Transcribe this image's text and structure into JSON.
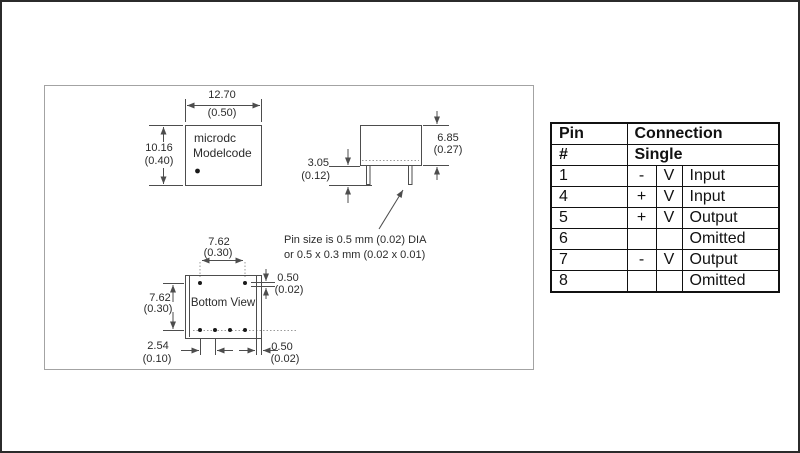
{
  "drawing": {
    "top_view": {
      "width_mm": "12.70",
      "width_in": "(0.50)",
      "height_mm": "10.16",
      "height_in": "(0.40)",
      "label_line1": "microdc",
      "label_line2": "Modelcode"
    },
    "side_view": {
      "body_height_mm": "6.85",
      "body_height_in": "(0.27)",
      "pin_length_mm": "3.05",
      "pin_length_in": "(0.12)"
    },
    "pin_note_line1": "Pin size is 0.5 mm (0.02) DIA",
    "pin_note_line2": "or 0.5 x 0.3 mm (0.02 x 0.01)",
    "bottom_view": {
      "label": "Bottom View",
      "pin_span_mm": "7.62",
      "pin_span_in": "(0.30)",
      "row_span_mm": "7.62",
      "row_span_in": "(0.30)",
      "pitch_mm": "2.54",
      "pitch_in": "(0.10)",
      "edge_offset_mm": "0.50",
      "edge_offset_in": "(0.02)",
      "side_offset_mm": "0.50",
      "side_offset_in": "(0.02)"
    }
  },
  "pin_table": {
    "header_col1": "Pin",
    "header_col2": "Connection",
    "subheader_col1": "#",
    "subheader_col2": "Single",
    "rows": [
      {
        "pin": "1",
        "sign": "-",
        "unit": "V",
        "connection": "Input"
      },
      {
        "pin": "4",
        "sign": "+",
        "unit": "V",
        "connection": "Input"
      },
      {
        "pin": "5",
        "sign": "+",
        "unit": "V",
        "connection": "Output"
      },
      {
        "pin": "6",
        "sign": "",
        "unit": "",
        "connection": "Omitted"
      },
      {
        "pin": "7",
        "sign": "-",
        "unit": "V",
        "connection": "Output"
      },
      {
        "pin": "8",
        "sign": "",
        "unit": "",
        "connection": "Omitted"
      }
    ]
  }
}
